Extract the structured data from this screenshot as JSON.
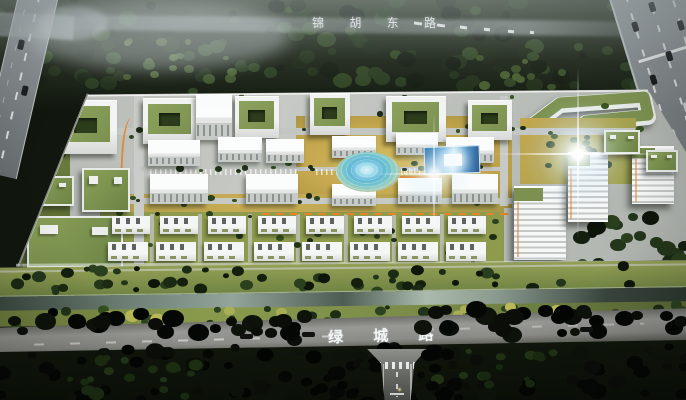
{
  "labels": {
    "north_road": "锦 胡 东 路",
    "south_road": "绿 城 路"
  },
  "colors": {
    "forest_top": "#18210f",
    "forest_bottom": "#0b100a",
    "haze": "#ccd3d6",
    "road_gray": "#95999b",
    "asphalt_dark": "#5f6160",
    "campus_ground": "#b6bab5",
    "lawn_olive": "#8e9a4c",
    "lawn_gold": "#c4a74e",
    "grass_green": "#6f8242",
    "tree_dark": "#16220f",
    "building_white": "#eff2f2",
    "roof_green": "#7c9150",
    "water_teal": "#62b8d6",
    "pool_blue": "#3f88c0",
    "accent_orange": "#e5832f",
    "canal_gray": "#5c6b62",
    "text_white": "#f3f6f6"
  }
}
